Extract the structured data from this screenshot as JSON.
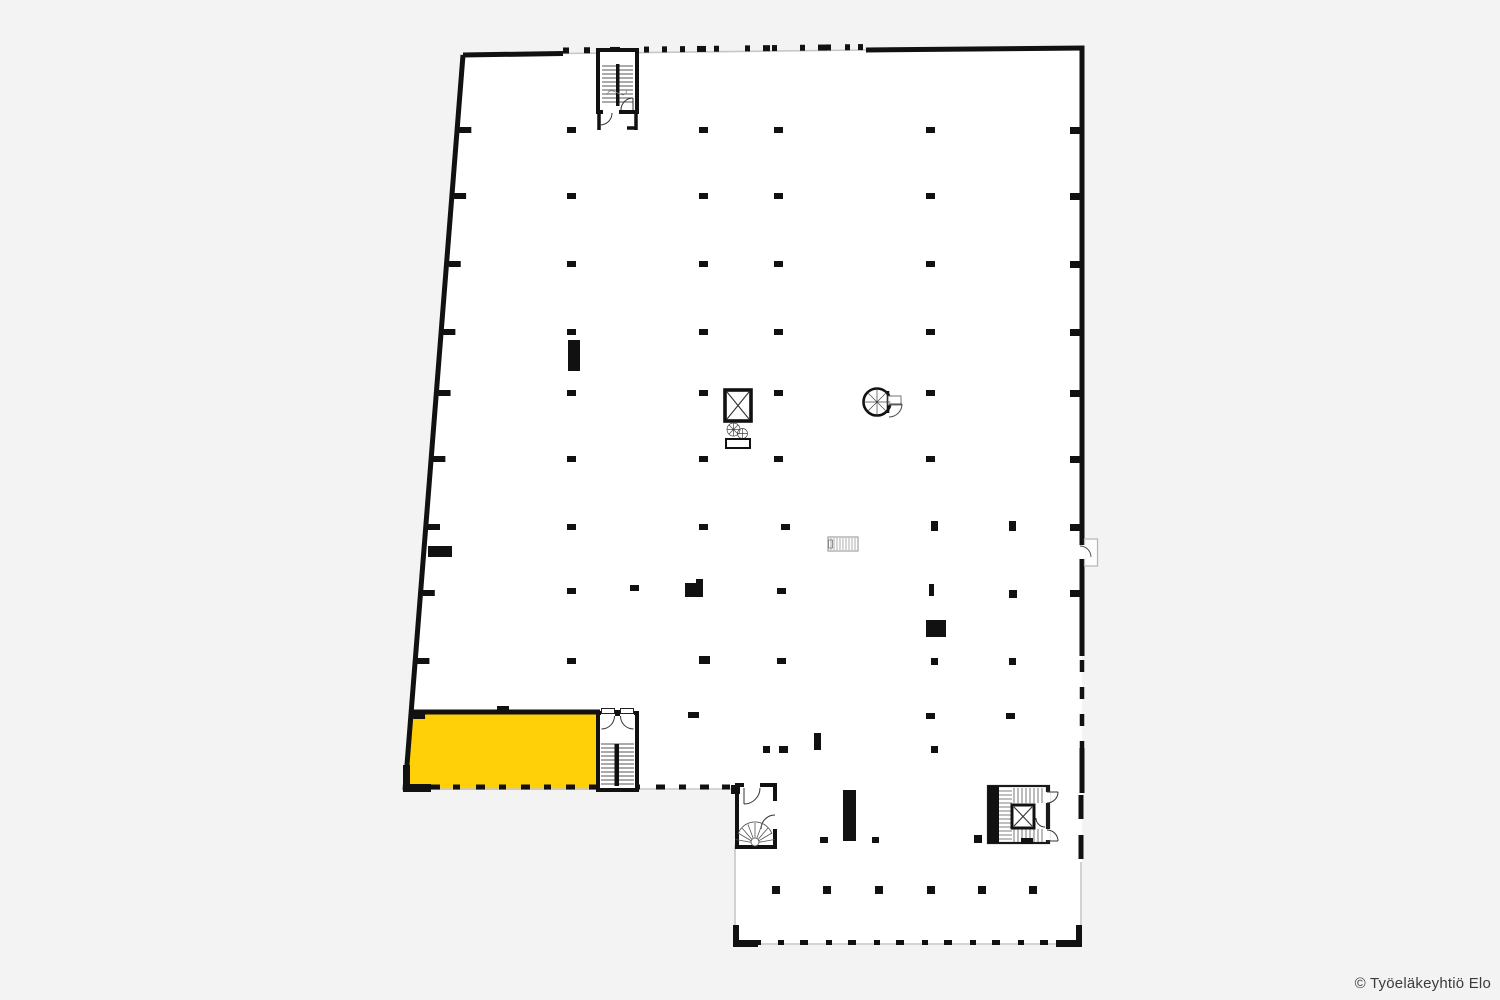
{
  "canvas": {
    "width": 1500,
    "height": 1000,
    "colors": {
      "bg": "#F4F3F4",
      "plan": "#FFFFFF",
      "wall": "#111111",
      "highlight": "#FFD008",
      "window_line": "#C7C7C7",
      "detail": "#555555",
      "text": "#3B3B3D"
    }
  },
  "footer": {
    "copyright": "© Työeläkeyhtiö Elo"
  },
  "plan": {
    "building_outline_points": "463,55 1082,48 1082,945 735,945 735,790 405,790",
    "highlighted_area_points": "411,712 598,712 598,790 405,790",
    "columns": [
      [
        567,
        127
      ],
      [
        699,
        127
      ],
      [
        774,
        127
      ],
      [
        926,
        127
      ],
      [
        567,
        193
      ],
      [
        699,
        193
      ],
      [
        774,
        193
      ],
      [
        926,
        193
      ],
      [
        567,
        261
      ],
      [
        699,
        261
      ],
      [
        774,
        261
      ],
      [
        926,
        261
      ],
      [
        567,
        329
      ],
      [
        699,
        329
      ],
      [
        774,
        329
      ],
      [
        926,
        329
      ],
      [
        567,
        390
      ],
      [
        699,
        390
      ],
      [
        774,
        390
      ],
      [
        926,
        390
      ],
      [
        567,
        456
      ],
      [
        699,
        456
      ],
      [
        774,
        456
      ],
      [
        926,
        456
      ],
      [
        567,
        524
      ],
      [
        699,
        524
      ],
      [
        781,
        524
      ],
      [
        931,
        521,
        7,
        10
      ],
      [
        1009,
        521,
        7,
        10
      ],
      [
        567,
        588
      ],
      [
        630,
        585
      ],
      [
        777,
        588
      ],
      [
        1009,
        590,
        8,
        8
      ],
      [
        567,
        658
      ],
      [
        699,
        656,
        11,
        8
      ],
      [
        777,
        658
      ],
      [
        931,
        658,
        7,
        7
      ],
      [
        1009,
        658,
        7,
        7
      ],
      [
        688,
        712,
        11,
        6
      ],
      [
        926,
        713
      ],
      [
        1006,
        713
      ],
      [
        763,
        746,
        7,
        7
      ],
      [
        779,
        746,
        9,
        7
      ],
      [
        931,
        746,
        7,
        7
      ],
      [
        820,
        837,
        8,
        6
      ],
      [
        872,
        837,
        7,
        6
      ],
      [
        974,
        835,
        8,
        8
      ]
    ],
    "left_wall_ticks": [
      127,
      193,
      261,
      329,
      390,
      456,
      524,
      590,
      658,
      713
    ],
    "right_wall_ticks": [
      127,
      193,
      261,
      329,
      390,
      456,
      524,
      590
    ],
    "top_window_mullions": [
      [
        563,
        6
      ],
      [
        584,
        6
      ],
      [
        610,
        10
      ],
      [
        644,
        5
      ],
      [
        662,
        5
      ],
      [
        680,
        5
      ],
      [
        697,
        9
      ],
      [
        714,
        5
      ],
      [
        745,
        5
      ],
      [
        763,
        7
      ],
      [
        772,
        5
      ],
      [
        800,
        5
      ],
      [
        818,
        9
      ],
      [
        826,
        5
      ],
      [
        845,
        5
      ],
      [
        858,
        5
      ]
    ],
    "bottom_wall_dashes": [
      [
        431,
        9
      ],
      [
        453,
        7
      ],
      [
        476,
        9
      ],
      [
        499,
        7
      ],
      [
        521,
        9
      ],
      [
        544,
        7
      ],
      [
        566,
        9
      ],
      [
        589,
        7
      ],
      [
        610,
        9
      ],
      [
        633,
        7
      ],
      [
        656,
        9
      ],
      [
        679,
        7
      ],
      [
        700,
        9
      ],
      [
        722,
        8
      ]
    ],
    "annex_bottom_dashes": [
      [
        753,
        8
      ],
      [
        778,
        6
      ],
      [
        800,
        8
      ],
      [
        826,
        6
      ],
      [
        848,
        8
      ],
      [
        874,
        6
      ],
      [
        896,
        8
      ],
      [
        922,
        6
      ],
      [
        944,
        8
      ],
      [
        970,
        6
      ],
      [
        992,
        8
      ],
      [
        1018,
        6
      ],
      [
        1040,
        8
      ],
      [
        1062,
        6
      ]
    ],
    "annex_columns": [
      772,
      823,
      875,
      927,
      978,
      1029
    ]
  }
}
